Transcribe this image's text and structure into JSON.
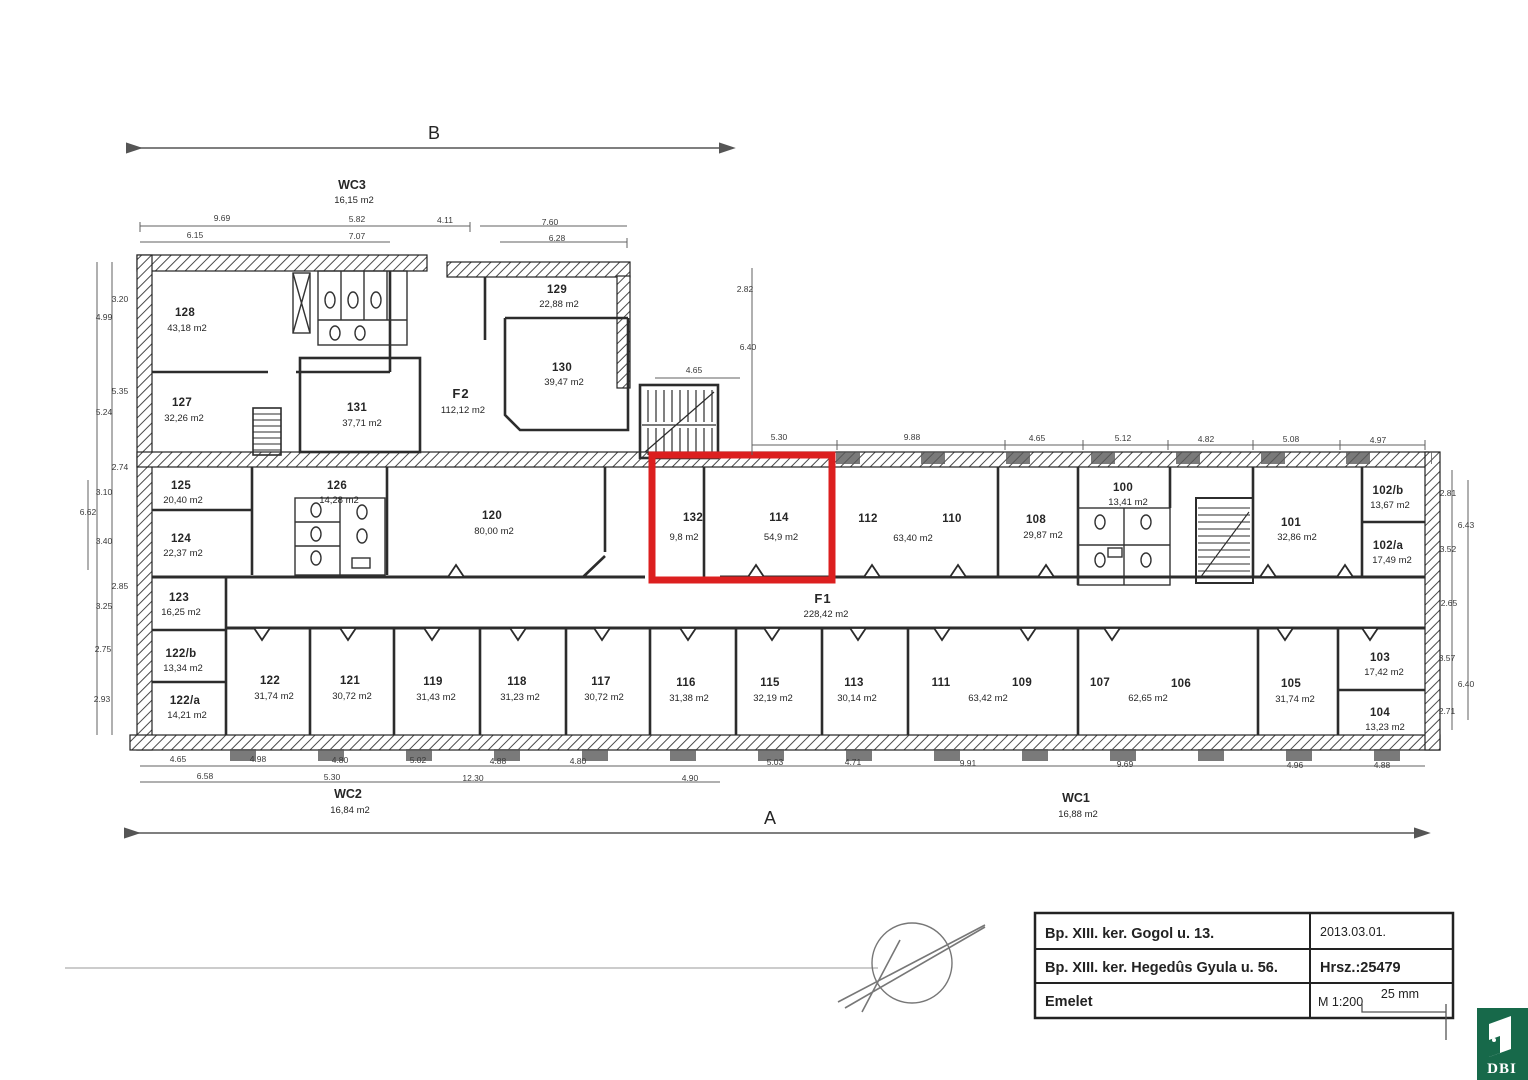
{
  "axis": {
    "top": "B",
    "bottom": "A"
  },
  "wc": {
    "wc3": {
      "name": "WC3",
      "area": "16,15 m2"
    },
    "wc2": {
      "name": "WC2",
      "area": "16,84 m2"
    },
    "wc1": {
      "name": "WC1",
      "area": "16,88 m2"
    }
  },
  "rooms": {
    "r128": {
      "n": "128",
      "a": "43,18 m2"
    },
    "r127": {
      "n": "127",
      "a": "32,26 m2"
    },
    "r131": {
      "n": "131",
      "a": "37,71 m2"
    },
    "f2": {
      "n": "F2",
      "a": "112,12 m2"
    },
    "r129": {
      "n": "129",
      "a": "22,88 m2"
    },
    "r130": {
      "n": "130",
      "a": "39,47 m2"
    },
    "r125": {
      "n": "125",
      "a": "20,40 m2"
    },
    "r124": {
      "n": "124",
      "a": "22,37 m2"
    },
    "r126": {
      "n": "126",
      "a": "14,28 m2"
    },
    "r120": {
      "n": "120",
      "a": "80,00 m2"
    },
    "r132": {
      "n": "132",
      "a": "9,8 m2"
    },
    "r114": {
      "n": "114",
      "a": "54,9 m2"
    },
    "r112": {
      "n": "112"
    },
    "r110": {
      "n": "110",
      "a": "63,40 m2"
    },
    "r108": {
      "n": "108",
      "a": "29,87 m2"
    },
    "r100": {
      "n": "100",
      "a": "13,41 m2"
    },
    "r101": {
      "n": "101",
      "a": "32,86 m2"
    },
    "r102b": {
      "n": "102/b",
      "a": "13,67 m2"
    },
    "r102a": {
      "n": "102/a",
      "a": "17,49 m2"
    },
    "f1": {
      "n": "F1",
      "a": "228,42 m2"
    },
    "r123": {
      "n": "123",
      "a": "16,25 m2"
    },
    "r122b": {
      "n": "122/b",
      "a": "13,34 m2"
    },
    "r122a": {
      "n": "122/a",
      "a": "14,21 m2"
    },
    "r122": {
      "n": "122",
      "a": "31,74 m2"
    },
    "r121": {
      "n": "121",
      "a": "30,72 m2"
    },
    "r119": {
      "n": "119",
      "a": "31,43 m2"
    },
    "r118": {
      "n": "118",
      "a": "31,23 m2"
    },
    "r117": {
      "n": "117",
      "a": "30,72 m2"
    },
    "r116": {
      "n": "116",
      "a": "31,38 m2"
    },
    "r115": {
      "n": "115",
      "a": "32,19 m2"
    },
    "r113": {
      "n": "113",
      "a": "30,14 m2"
    },
    "r111": {
      "n": "111"
    },
    "r109": {
      "n": "109",
      "a": "63,42 m2"
    },
    "r107": {
      "n": "107"
    },
    "r106": {
      "n": "106",
      "a": "62,65 m2"
    },
    "r105": {
      "n": "105",
      "a": "31,74 m2"
    },
    "r103": {
      "n": "103",
      "a": "17,42 m2"
    },
    "r104": {
      "n": "104",
      "a": "13,23 m2"
    }
  },
  "dims": {
    "top1": [
      "9.69",
      "5.82",
      "4.11",
      "7.60"
    ],
    "top2": [
      "6.15",
      "7.07",
      "6.28"
    ],
    "left": [
      "3.20",
      "4.99",
      "5.35",
      "5.24",
      "2.74",
      "3.10",
      "6.62",
      "3.40",
      "2.85",
      "3.25",
      "2.75",
      "2.93"
    ],
    "mid": [
      "5.30",
      "9.88",
      "4.65",
      "5.12",
      "4.82",
      "5.08",
      "4.97"
    ],
    "stair": [
      "2.82",
      "6.40",
      "4.65"
    ],
    "right": [
      "2.81",
      "6.43",
      "3.52",
      "2.65",
      "3.57",
      "6.40",
      "2.71"
    ],
    "bot1": [
      "4.65",
      "4.98",
      "4.80",
      "5.02",
      "4.88",
      "4.80",
      "5.03",
      "4.71",
      "9.91",
      "9.69",
      "4.96",
      "4.88"
    ],
    "bot2": [
      "6.58",
      "5.30",
      "12.30",
      "4.90"
    ]
  },
  "title_block": {
    "address1": "Bp. XIII. ker. Gogol u. 13.",
    "address2": "Bp. XIII. ker. Hegedûs Gyula u. 56.",
    "floor": "Emelet",
    "date": "2013.03.01.",
    "parcel": "Hrsz.:25479",
    "scale": "M 1:200",
    "scale_bar": "25 mm"
  },
  "logo": {
    "text": "DBI",
    "color": "#17694a"
  },
  "highlight": {
    "color": "#dc1f1f"
  }
}
